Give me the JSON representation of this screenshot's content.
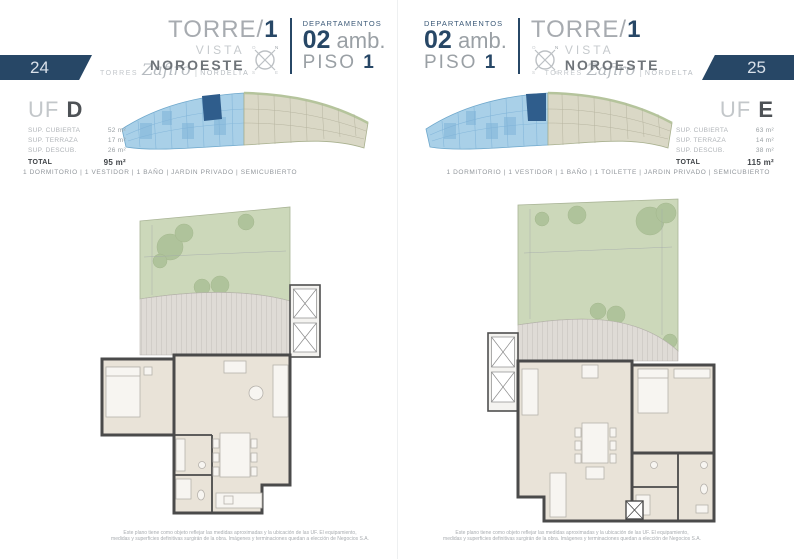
{
  "brand": {
    "torres": "Torres",
    "zafiro": "Zafiro",
    "separator": "|",
    "nordelta": "NORDELTA"
  },
  "compass": {
    "n": "N",
    "s": "S",
    "e": "E",
    "o": "O"
  },
  "colors": {
    "navy": "#274766",
    "title_gray": "#a7abb0",
    "dark_gray": "#6f7479",
    "garden_green": "#ccd8ba",
    "deck_gray": "#dfdbd6",
    "floor_beige": "#e9e3d8",
    "wall_gray": "#4a4a4a",
    "site_blue": "#a9d0e8",
    "site_highlight": "#2f5d8c",
    "site_beige": "#dad8c6"
  },
  "pages": [
    {
      "page_number": "24",
      "header": {
        "torre_label": "TORRE/",
        "torre_number": "1",
        "vista": "VISTA",
        "orientation": "NOROESTE",
        "dept_label": "DEPARTAMENTOS",
        "dept_number": "02",
        "dept_unit": "amb.",
        "piso_label": "PISO",
        "piso_number": "1"
      },
      "unit": {
        "uf_label": "UF",
        "uf_letter": "D",
        "surfaces": [
          {
            "label": "SUP. CUBIERTA",
            "value": "52 m²"
          },
          {
            "label": "SUP. TERRAZA",
            "value": "17 m²"
          },
          {
            "label": "SUP. DESCUB.",
            "value": "26 m²"
          }
        ],
        "total_label": "TOTAL",
        "total_value": "95 m²"
      },
      "features": "1 DORMITORIO | 1 VESTIDOR | 1 BAÑO | JARDIN PRIVADO | SEMICUBIERTO",
      "disclaimer_line1": "Este plano tiene como objeto reflejar las medidas aproximadas y la ubicación de las UF. El equipamiento,",
      "disclaimer_line2": "medidas y superficies definitivas surgirán de la obra. Imágenes y terminaciones quedan a elección de Negocios S.A."
    },
    {
      "page_number": "25",
      "header": {
        "torre_label": "TORRE/",
        "torre_number": "1",
        "vista": "VISTA",
        "orientation": "NOROESTE",
        "dept_label": "DEPARTAMENTOS",
        "dept_number": "02",
        "dept_unit": "amb.",
        "piso_label": "PISO",
        "piso_number": "1"
      },
      "unit": {
        "uf_label": "UF",
        "uf_letter": "E",
        "surfaces": [
          {
            "label": "SUP. CUBIERTA",
            "value": "63 m²"
          },
          {
            "label": "SUP. TERRAZA",
            "value": "14 m²"
          },
          {
            "label": "SUP. DESCUB.",
            "value": "38 m²"
          }
        ],
        "total_label": "TOTAL",
        "total_value": "115 m²"
      },
      "features": "1 DORMITORIO | 1 VESTIDOR | 1 BAÑO | 1 TOILETTE | JARDIN PRIVADO | SEMICUBIERTO",
      "disclaimer_line1": "Este plano tiene como objeto reflejar las medidas aproximadas y la ubicación de las UF. El equipamiento,",
      "disclaimer_line2": "medidas y superficies definitivas surgirán de la obra. Imágenes y terminaciones quedan a elección de Negocios S.A."
    }
  ]
}
